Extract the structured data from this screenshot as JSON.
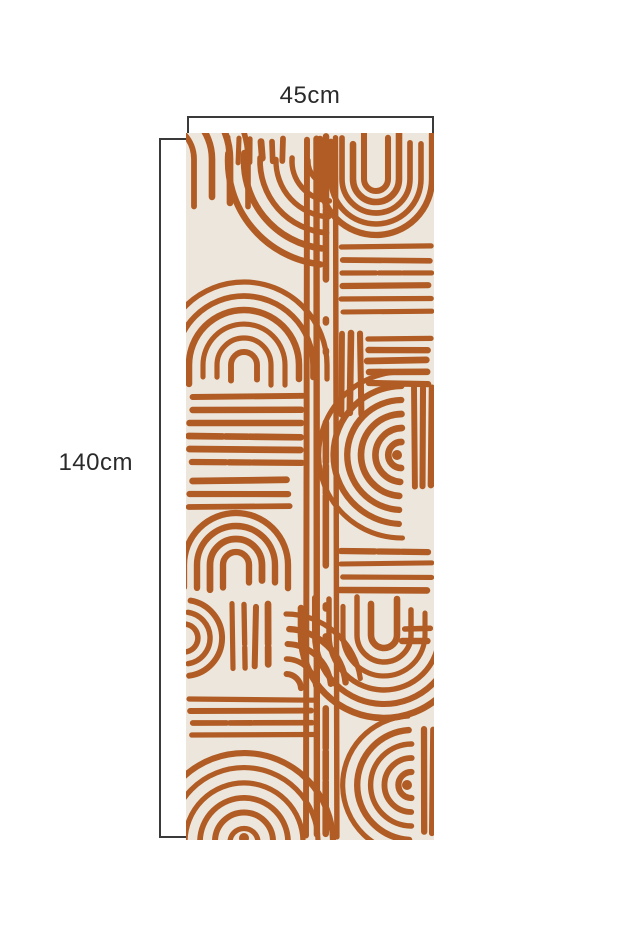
{
  "page": {
    "background": "#ffffff"
  },
  "dimensions": {
    "width_label": "45cm",
    "height_label": "140cm",
    "line_color": "#3a3a3a",
    "text_color": "#2a2a2a"
  },
  "panel": {
    "description": "terracotta abstract boho brush-stroke wallpaper panel",
    "background": "#ece6dc",
    "stroke_color": "#b05c24",
    "width_px": 248,
    "height_px": 707,
    "pattern_blocks": [
      {
        "type": "uarc",
        "cx": -28,
        "cy": 26,
        "radii": [
          36,
          54,
          72,
          90
        ],
        "legs": 52,
        "rot": 0
      },
      {
        "type": "vstripes",
        "x": 42,
        "y": 4,
        "len": 26,
        "n": 6,
        "step": 11
      },
      {
        "type": "arcs",
        "cx": 146,
        "cy": 28,
        "radii": [
          24,
          40,
          56,
          72,
          88,
          104
        ],
        "a0": 95,
        "a1": 183
      },
      {
        "type": "uarc",
        "cx": 58,
        "cy": 232,
        "radii": [
          13,
          27,
          41,
          55,
          69,
          83
        ],
        "legs": 16,
        "rot": 0
      },
      {
        "type": "hstripes",
        "x": 2,
        "y": 264,
        "len": 118,
        "n": 6,
        "step": 13
      },
      {
        "type": "hstripes",
        "x": 2,
        "y": 348,
        "len": 104,
        "n": 3,
        "step": 13
      },
      {
        "type": "uarc",
        "cx": 50,
        "cy": 432,
        "radii": [
          13,
          26,
          39,
          52
        ],
        "legs": 20,
        "rot": 0
      },
      {
        "type": "vstripes",
        "x": 46,
        "y": 470,
        "len": 66,
        "n": 4,
        "step": 12
      },
      {
        "type": "arcs",
        "cx": -2,
        "cy": 505,
        "radii": [
          14,
          26,
          38
        ],
        "a0": -80,
        "a1": 80
      },
      {
        "type": "arcs",
        "cx": 100,
        "cy": 556,
        "radii": [
          15,
          30,
          45,
          60,
          75
        ],
        "a0": -88,
        "a1": -6
      },
      {
        "type": "hstripes",
        "x": 2,
        "y": 566,
        "len": 126,
        "n": 4,
        "step": 12
      },
      {
        "type": "arcs",
        "cx": 58,
        "cy": 710,
        "radii": [
          14,
          29,
          44,
          59,
          74,
          89
        ],
        "a0": 183,
        "a1": 357,
        "dot": 5
      },
      {
        "type": "vstripes",
        "x": 121,
        "y": 2,
        "len": 703,
        "n": 4,
        "step": 9.5
      },
      {
        "type": "uarc",
        "cx": 190,
        "cy": 46,
        "radii": [
          12,
          23,
          34,
          45,
          56
        ],
        "legs": 40,
        "rot": 180
      },
      {
        "type": "hstripes",
        "x": 154,
        "y": 114,
        "len": 92,
        "n": 6,
        "step": 13
      },
      {
        "type": "vstripes",
        "x": 156,
        "y": 198,
        "len": 86,
        "n": 3,
        "step": 9
      },
      {
        "type": "hstripes",
        "x": 180,
        "y": 206,
        "len": 66,
        "n": 5,
        "step": 11
      },
      {
        "type": "arcs",
        "cx": 216,
        "cy": 322,
        "radii": [
          13,
          27,
          41,
          55,
          69,
          83
        ],
        "a0": 92,
        "a1": 268,
        "dot": 5
      },
      {
        "type": "vstripes",
        "x": 228,
        "y": 252,
        "len": 104,
        "n": 3,
        "step": 9
      },
      {
        "type": "hstripes",
        "x": 152,
        "y": 418,
        "len": 94,
        "n": 4,
        "step": 13
      },
      {
        "type": "uarc",
        "cx": 198,
        "cy": 502,
        "radii": [
          13,
          27,
          41,
          55,
          69,
          83
        ],
        "legs": 30,
        "rot": 180
      },
      {
        "type": "hstripes",
        "x": 214,
        "y": 496,
        "len": 32,
        "n": 2,
        "step": 12
      },
      {
        "type": "arcs",
        "cx": 226,
        "cy": 652,
        "radii": [
          13,
          27,
          41,
          55,
          69
        ],
        "a0": 92,
        "a1": 268,
        "dot": 5
      },
      {
        "type": "vstripes",
        "x": 238,
        "y": 592,
        "len": 110,
        "n": 2,
        "step": 9
      }
    ]
  }
}
